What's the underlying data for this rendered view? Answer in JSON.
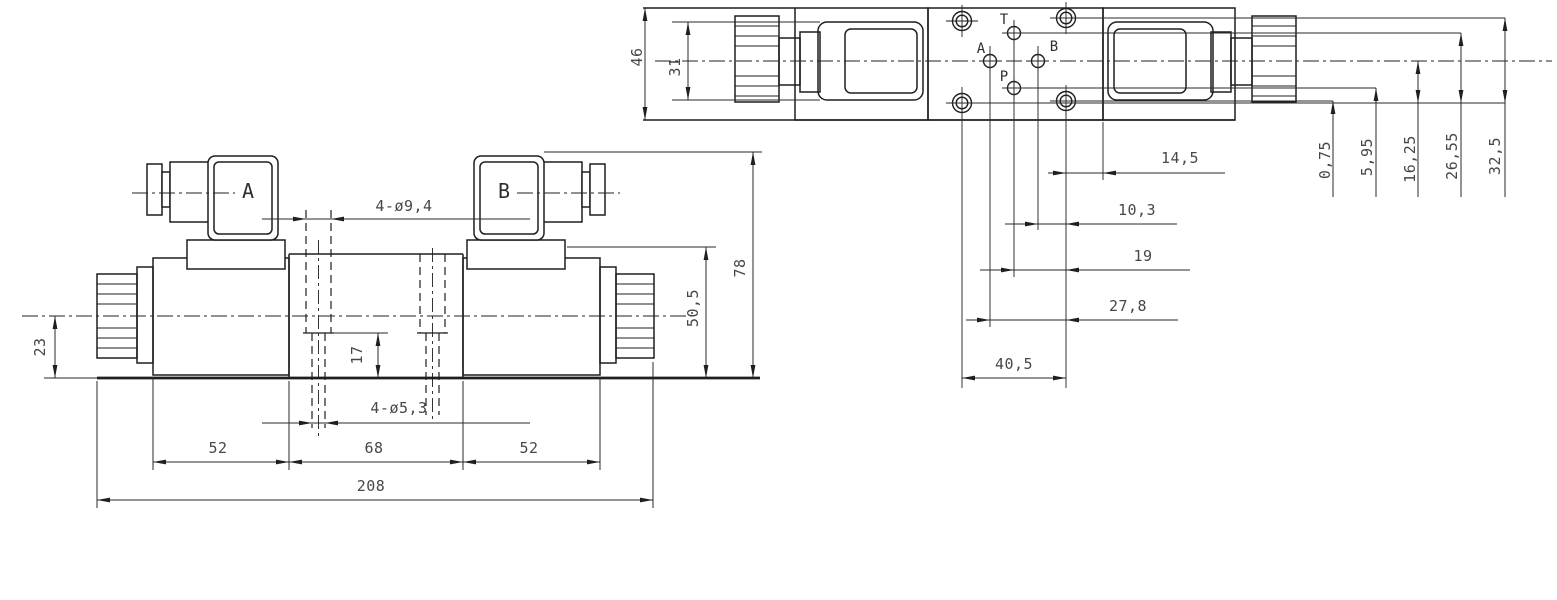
{
  "front_view": {
    "connector_a_label": "A",
    "connector_b_label": "B",
    "dim_body_to_base": "23",
    "dim_mount_holes_large": "4-ø9,4",
    "dim_hole_depth": "17",
    "dim_mount_holes_small": "4-ø5,3",
    "dim_left_solenoid": "52",
    "dim_valve_body": "68",
    "dim_right_solenoid": "52",
    "dim_overall_length": "208",
    "dim_solenoid_height": "50,5",
    "dim_overall_height": "78"
  },
  "top_view": {
    "port_t_label": "T",
    "port_a_label": "A",
    "port_b_label": "B",
    "port_p_label": "P",
    "dim_overall_width": "46",
    "dim_solenoid_width": "31",
    "dim_edge_to_holes": "14,5",
    "dim_port_b": "10,3",
    "dim_ports_tp": "19",
    "dim_port_a": "27,8",
    "dim_hole_spacing": "40,5",
    "dim_v_hole_offset": "0,75",
    "dim_v_port_p": "5,95",
    "dim_v_ports_ab": "16,25",
    "dim_v_port_t": "26,55",
    "dim_v_holes_top": "32,5"
  }
}
